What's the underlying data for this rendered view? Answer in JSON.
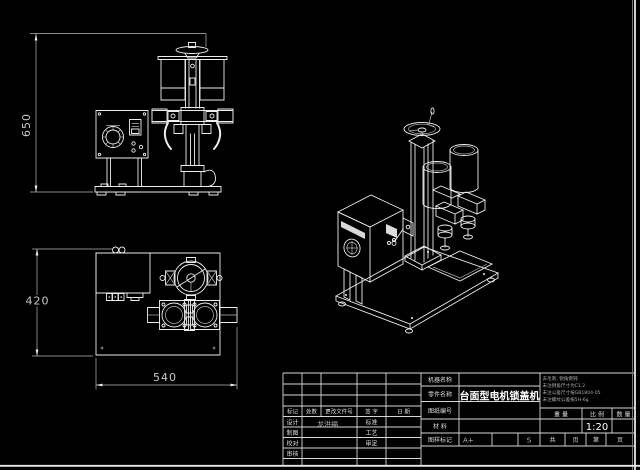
{
  "canvas": {
    "background": "#000000",
    "line_color": "#ededed"
  },
  "drawing": {
    "views": {
      "front": {
        "height_dim": "650"
      },
      "top": {
        "height_dim": "420",
        "width_dim": "540"
      }
    }
  },
  "title_block": {
    "labels": {
      "machine_name": "机器名称",
      "part_name": "零件名称",
      "drawing_no": "图纸编号",
      "material": "材  料",
      "mark": "图样标记",
      "weight": "重 量",
      "scale": "比 例",
      "qty": "数 量",
      "sheets_total": "共",
      "sheet_word": "页",
      "sheet_no": "第",
      "sheet_word2": "页"
    },
    "values": {
      "part_name": "台面型电机锁盖机",
      "scale": "1:20",
      "mark": "A+",
      "grade": "S"
    },
    "notes": [
      "去毛刺, 锐角倒钝",
      "未注倒角尺寸为C1.2",
      "未注公差尺寸按GB1804-05",
      "未注螺纹公差按5H-6g"
    ],
    "revision_header": {
      "mark": "标记",
      "count": "处数",
      "file_no": "更改文件号",
      "sign": "签 字",
      "date": "日 期"
    },
    "sign_rows": [
      {
        "label": "设计",
        "name": "龙洪福",
        "label2": "标准"
      },
      {
        "label": "制图",
        "label2": "工艺"
      },
      {
        "label": "校对",
        "label2": "审定"
      },
      {
        "label": "审核"
      }
    ]
  }
}
